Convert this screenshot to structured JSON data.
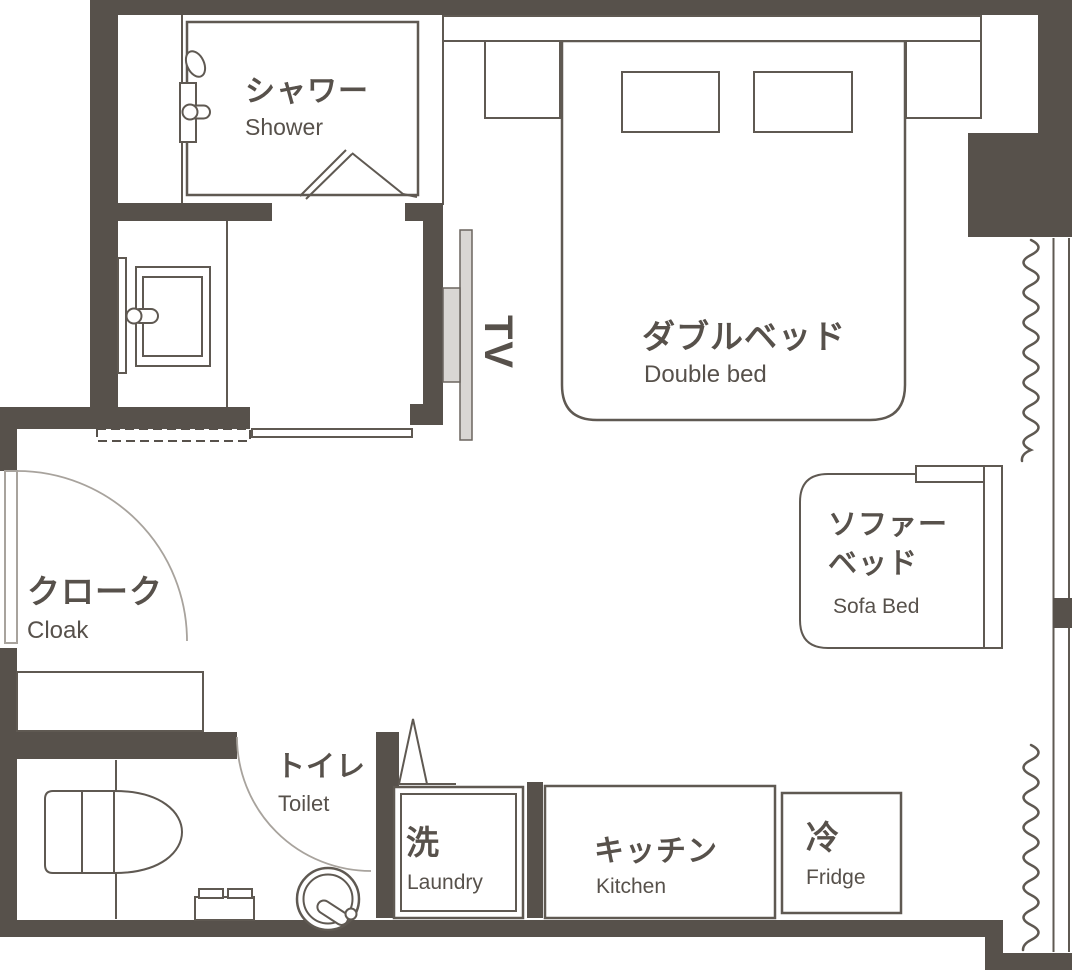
{
  "document": {
    "type": "floor-plan",
    "background": "#ffffff"
  },
  "colors": {
    "wall": "#57514b",
    "line": "#5f5952",
    "light_line": "#a8a39d",
    "fixture_fill": "#d9d6d3",
    "text": "#57514b"
  },
  "labels": {
    "shower": {
      "jp": "シャワー",
      "en": "Shower"
    },
    "double_bed": {
      "jp": "ダブルベッド",
      "en": "Double bed"
    },
    "sofa_bed": {
      "jp_line1": "ソファー",
      "jp_line2": "ベッド",
      "en": "Sofa Bed"
    },
    "cloak": {
      "jp": "クローク",
      "en": "Cloak"
    },
    "toilet": {
      "jp": "トイレ",
      "en": "Toilet"
    },
    "laundry": {
      "jp": "洗",
      "en": "Laundry"
    },
    "kitchen": {
      "jp": "キッチン",
      "en": "Kitchen"
    },
    "fridge": {
      "jp": "冷",
      "en": "Fridge"
    },
    "tv": {
      "en": "TV"
    }
  }
}
